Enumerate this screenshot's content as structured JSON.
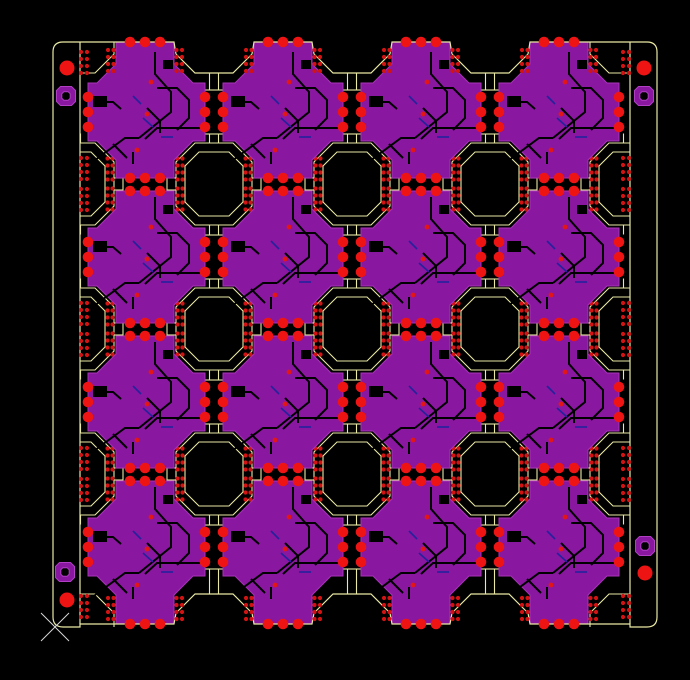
{
  "window": {
    "width": 690,
    "height": 680,
    "background": "#000000"
  },
  "colors": {
    "background": "#000000",
    "outline": "#e9e9a4",
    "copper": "#8a17a0",
    "copper_edge": "#a733b8",
    "pad_red": "#ee1414",
    "small_hole_red": "#d21313",
    "via_red": "#e31616",
    "trace_black": "#000000",
    "trace_navy": "#22229c",
    "ring_purple": "#8a17a0",
    "ring_edge": "#b03fc4",
    "cursor": "#d8d8d8"
  },
  "panel": {
    "outer": {
      "x1": 53,
      "y1": 42,
      "x2": 657,
      "y2": 627,
      "corner_radius": 10
    },
    "rail_inner_left_x": 80,
    "rail_inner_right_x": 630,
    "module_edge_top_y": 42,
    "module_edge_bottom_y": 624,
    "notch_flat_top_y": 73,
    "notch_flat_bottom_y": 594,
    "notch_shoulder_top_y": 54,
    "notch_shoulder_bottom_y": 613
  },
  "grid": {
    "cross_cols": [
      145,
      283,
      421,
      559
    ],
    "cross_rows": [
      112,
      257,
      402,
      547
    ],
    "cell_cols": [
      214,
      352,
      490
    ],
    "edge_cell_cols": [
      76,
      628
    ],
    "cell_rows": [
      184,
      329,
      474
    ],
    "corner_cell_rows": [
      32,
      635
    ]
  },
  "cross": {
    "arm_half_width": 29,
    "chamfer": 48,
    "arm_len_side": 60,
    "arm_len_side_left_edge": 57,
    "arm_len_vert": 66,
    "arm_len_top_edge": 70,
    "arm_len_bottom_edge": 77,
    "pad_radius": 5.3,
    "pad_spacing": 15,
    "pads_per_arm": 3,
    "count": 16,
    "notches": [
      [
        -52,
        -16,
        14,
        11
      ],
      [
        18,
        -52,
        10,
        9
      ]
    ],
    "traces_black": [
      [
        [
          -58,
          54
        ],
        [
          -20,
          26
        ],
        [
          -6,
          26
        ]
      ],
      [
        [
          -6,
          26
        ],
        [
          26,
          0
        ],
        [
          26,
          -20
        ],
        [
          10,
          -38
        ],
        [
          10,
          -60
        ]
      ],
      [
        [
          60,
          16
        ],
        [
          12,
          16
        ],
        [
          0,
          27
        ]
      ],
      [
        [
          -48,
          -10
        ],
        [
          -32,
          -10
        ],
        [
          -24,
          -3
        ]
      ],
      [
        [
          2,
          -4
        ],
        [
          15,
          9
        ],
        [
          15,
          21
        ]
      ],
      [
        [
          -32,
          32
        ],
        [
          -18,
          46
        ]
      ],
      [
        [
          12,
          -24
        ],
        [
          32,
          -24
        ],
        [
          44,
          -12
        ],
        [
          44,
          6
        ],
        [
          32,
          18
        ]
      ],
      [
        [
          -12,
          52
        ],
        [
          -12,
          40
        ]
      ]
    ],
    "traces_navy": [
      [
        [
          -2,
          6
        ],
        [
          8,
          15
        ]
      ],
      [
        [
          16,
          25
        ],
        [
          28,
          25
        ]
      ],
      [
        [
          -12,
          -16
        ],
        [
          -4,
          -8
        ]
      ]
    ],
    "vias": [
      [
        2,
        2
      ],
      [
        -8,
        38
      ],
      [
        6,
        -30
      ]
    ],
    "via_radius": 2.4
  },
  "cell": {
    "outer": {
      "hw": 38,
      "hh": 41,
      "ch": 19
    },
    "inner": {
      "hw": 29,
      "hh": 32,
      "ch": 14
    },
    "strip_col_offsets": [
      31.5,
      36.5
    ],
    "strip_row_offsets": [
      4.5,
      11.5,
      18.5,
      25.5
    ],
    "strip_dot_radius": 2.1,
    "stub_half_gap": 4.5,
    "stub_len": 9.5
  },
  "tabs": {
    "half_len": 22,
    "half_width": 15,
    "horizontal_count": 12,
    "vertical_count": 12
  },
  "edge_strips": {
    "flank_col_offsets": [
      -37,
      -31.5,
      31.5,
      37
    ],
    "top_rows": [
      50,
      57,
      64,
      71
    ],
    "bottom_rows": [
      598,
      605,
      612,
      619
    ],
    "rail_cols_left": [
      81,
      87
    ],
    "rail_cols_right": [
      623,
      629
    ],
    "rail_top_rows": [
      52,
      59,
      66,
      73
    ],
    "rail_bottom_rows": [
      596,
      603,
      610,
      617
    ],
    "rail_cell_row_offsets": [
      -26,
      -19,
      -12,
      -5,
      5,
      12,
      19,
      26
    ]
  },
  "fiducials": {
    "radius": 7.5,
    "points": [
      {
        "x": 67,
        "y": 68
      },
      {
        "x": 644,
        "y": 68
      },
      {
        "x": 67,
        "y": 600
      },
      {
        "x": 645,
        "y": 573
      }
    ]
  },
  "tooling_holes": {
    "outer_radius": 9.5,
    "inner_radius": 4.2,
    "points": [
      {
        "x": 66,
        "y": 96
      },
      {
        "x": 644,
        "y": 96
      },
      {
        "x": 65,
        "y": 572
      },
      {
        "x": 645,
        "y": 546
      }
    ]
  },
  "cursor": {
    "x": 55,
    "y": 627,
    "arm": 14
  }
}
